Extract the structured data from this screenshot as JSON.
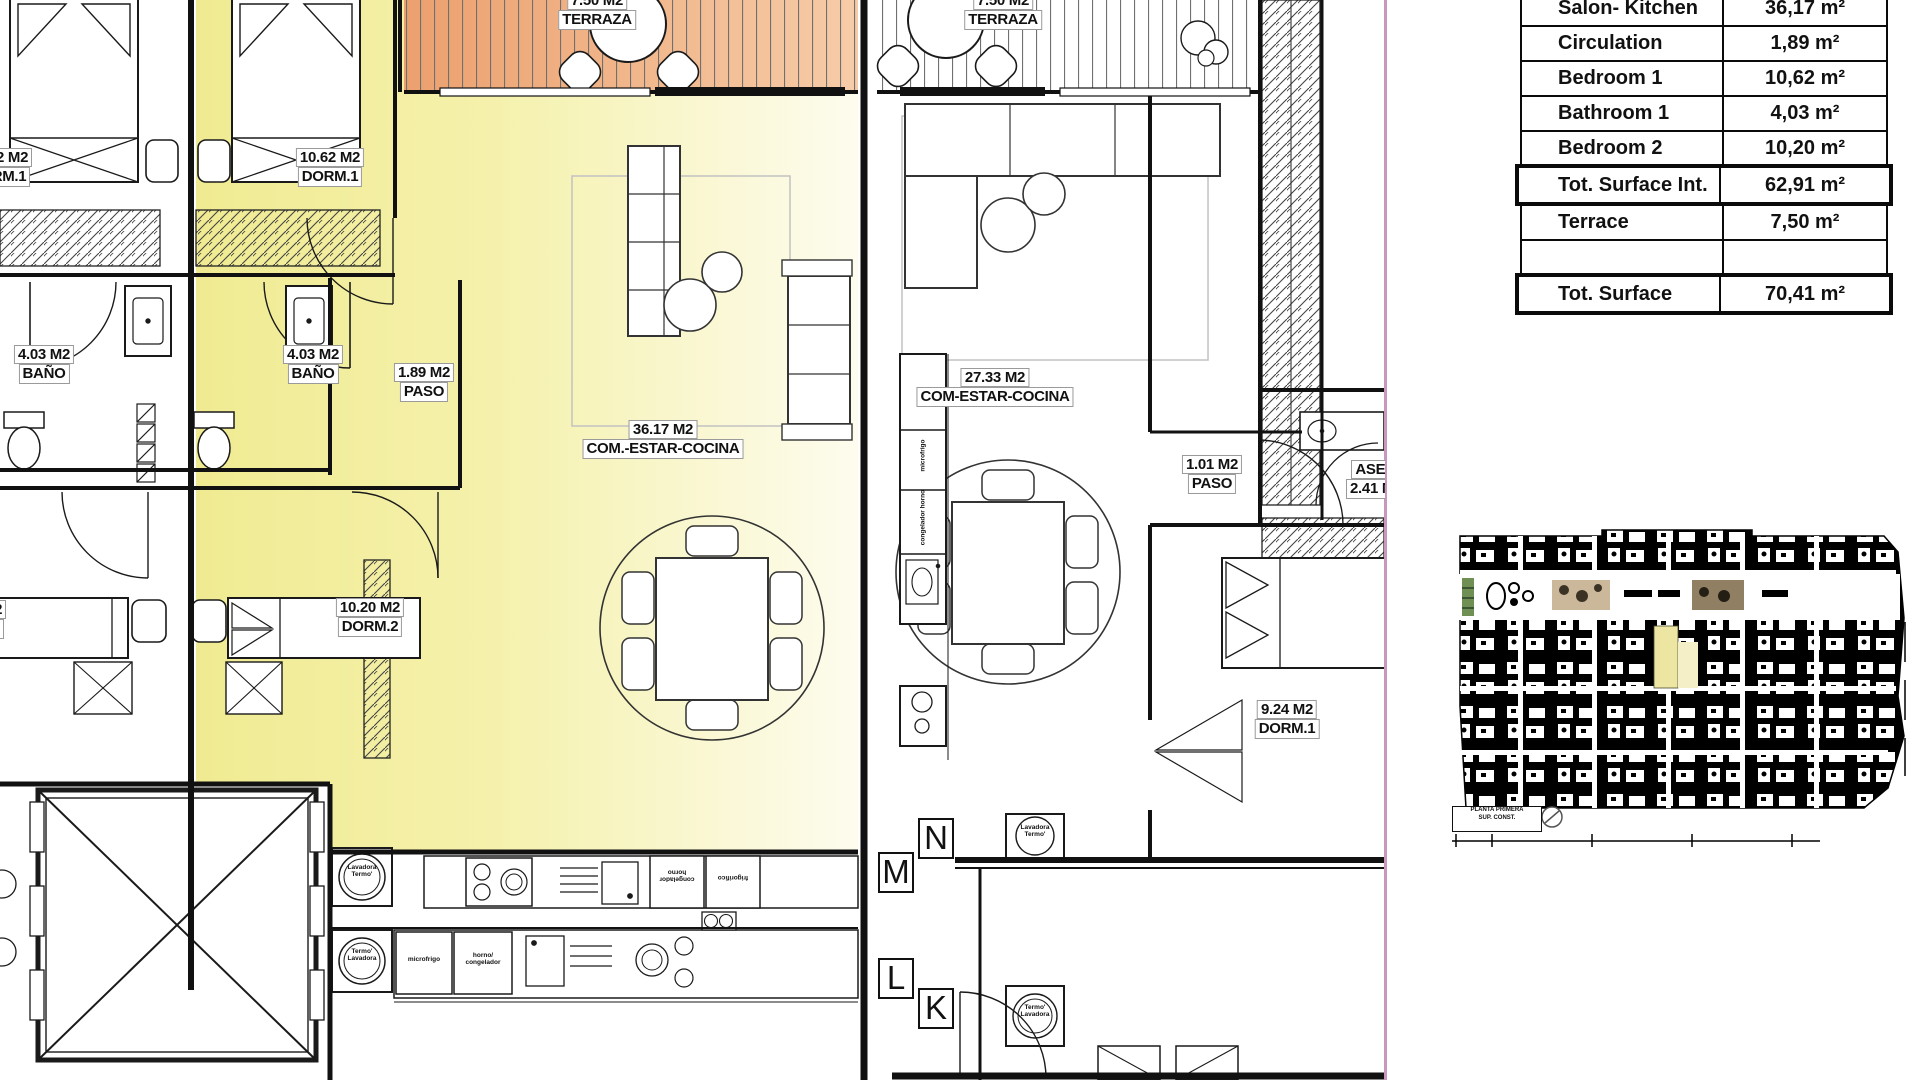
{
  "colors": {
    "highlight_yellow": "#F2EE9C",
    "terrace_orange": "#EFAE85",
    "boundary_pink": "#C897BC",
    "wall_black": "#111111"
  },
  "surface_table": {
    "rows": [
      {
        "label": "Salon- Kitchen",
        "value": "36,17 m²",
        "bold": false
      },
      {
        "label": "Circulation",
        "value": "1,89 m²",
        "bold": false
      },
      {
        "label": "Bedroom 1",
        "value": "10,62 m²",
        "bold": false
      },
      {
        "label": "Bathroom 1",
        "value": "4,03 m²",
        "bold": false
      },
      {
        "label": "Bedroom 2",
        "value": "10,20 m²",
        "bold": false
      },
      {
        "label": "Tot. Surface Int.",
        "value": "62,91 m²",
        "bold": true
      },
      {
        "label": "Terrace",
        "value": "7,50 m²",
        "bold": false
      },
      {
        "label": "",
        "value": "",
        "bold": false
      },
      {
        "label": "Tot. Surface",
        "value": "70,41 m²",
        "bold": true
      }
    ]
  },
  "rooms": {
    "terrace_left": {
      "line1": "7.50 M2",
      "line2": "TERRAZA"
    },
    "terrace_right": {
      "line1": "7.50 M2",
      "line2": "TERRAZA"
    },
    "dorm1_left": {
      "line1": "10.62 M2",
      "line2": "DORM.1"
    },
    "dorm1_main": {
      "line1": "10.62 M2",
      "line2": "DORM.1"
    },
    "bath_left": {
      "line1": "4.03 M2",
      "line2": "BAÑO"
    },
    "bath_main": {
      "line1": "4.03 M2",
      "line2": "BAÑO"
    },
    "paso_main": {
      "line1": "1.89 M2",
      "line2": "PASO"
    },
    "living_main": {
      "line1": "36.17 M2",
      "line2": "COM.-ESTAR-COCINA"
    },
    "dorm2_left": {
      "line1": "10.20 M2",
      "line2": "DORM.2"
    },
    "dorm2_main": {
      "line1": "10.20 M2",
      "line2": "DORM.2"
    },
    "living_right": {
      "line1": "27.33 M2",
      "line2": "COM-ESTAR-COCINA"
    },
    "paso_right": {
      "line1": "1.01 M2",
      "line2": "PASO"
    },
    "aseo_right": {
      "line1": "ASEO",
      "line2": "2.41 M2"
    },
    "dorm1_right": {
      "line1": "9.24 M2",
      "line2": "DORM.1"
    }
  },
  "letters": [
    "N",
    "M",
    "L",
    "K"
  ],
  "appliances": {
    "wash_left_top": "Lavadora\nTermo'",
    "wash_left_bottom": "Termo'\nLavadora",
    "fridge_row_a1": "congelador\nhorno",
    "fridge_row_a2": "frigorifico",
    "micro_row_b": "microfrigo",
    "oven_row_b": "horno/\ncongelador",
    "tower_micro": "microfrigo",
    "tower_cong": "congelador horno",
    "wash_right_top": "Lavadora\nTermo'",
    "wash_right_bottom": "Termo'\nLavadora"
  },
  "miniplan": {
    "caption_line1": "PLANTA PRIMERA",
    "caption_line2": "SUP. CONST."
  }
}
